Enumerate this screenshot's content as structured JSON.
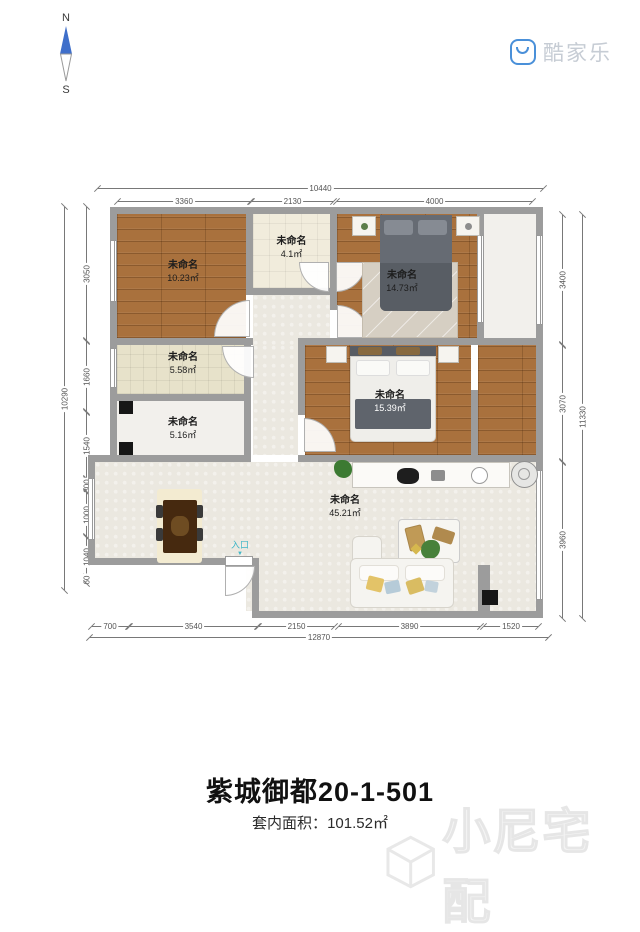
{
  "compass": {
    "north": "N",
    "south": "S"
  },
  "brand": {
    "name": "酷家乐",
    "accent_color": "#4a90d9"
  },
  "plan": {
    "wall_color": "#9c9c9c",
    "rooms": [
      {
        "id": "bedroom-top-left",
        "name": "未命名",
        "area": "10.23㎡"
      },
      {
        "id": "hall-small",
        "name": "未命名",
        "area": "4.1㎡"
      },
      {
        "id": "bedroom-top-right",
        "name": "未命名",
        "area": "14.73㎡"
      },
      {
        "id": "storage-mid",
        "name": "未命名",
        "area": "5.58㎡"
      },
      {
        "id": "storage-lower",
        "name": "未命名",
        "area": "5.16㎡"
      },
      {
        "id": "bedroom-middle",
        "name": "未命名",
        "area": "15.39㎡"
      },
      {
        "id": "living-room",
        "name": "未命名",
        "area": "45.21㎡"
      }
    ],
    "entrance": {
      "label": "入口",
      "arrow": "▼",
      "color": "#3fb6c7"
    },
    "dimensions": {
      "top": {
        "total": "10440",
        "segments": [
          "3360",
          "2130",
          "4000"
        ]
      },
      "bottom": {
        "total": "12870",
        "segments": [
          "700",
          "3540",
          "2150",
          "3890",
          "1520"
        ]
      },
      "left": {
        "total": "10290",
        "segments": [
          "3050",
          "1660",
          "1540",
          "300",
          "1000",
          "1040",
          "60"
        ]
      },
      "right": {
        "total": "11330",
        "segments": [
          "3400",
          "3070",
          "3960"
        ]
      }
    }
  },
  "footer": {
    "title": "紫城御都20-1-501",
    "area_label": "套内面积：",
    "area_value": "101.52㎡"
  },
  "watermark": {
    "text": "小尼宅配"
  }
}
